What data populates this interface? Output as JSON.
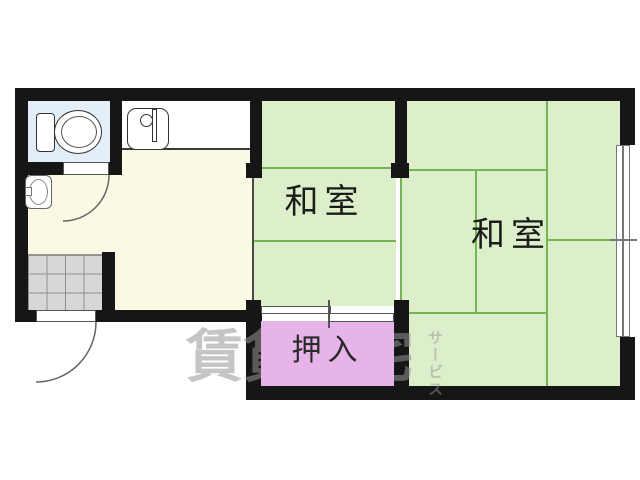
{
  "plan": {
    "type": "japanese-apartment-floor-plan",
    "rooms": {
      "washitsu_center": {
        "label": "和室"
      },
      "washitsu_right": {
        "label": "和室"
      },
      "closet": {
        "label": "押入"
      }
    },
    "watermark": {
      "main": "賃貸住宅",
      "vertical": "サービス"
    },
    "fixtures": [
      "toilet-icon",
      "kitchen-sink-icon",
      "wash-basin-icon",
      "entrance-tile-floor",
      "hinged-door-toilet",
      "hinged-door-entrance",
      "sliding-door-closet",
      "sliding-window-right"
    ],
    "colors": {
      "wall": "#161616",
      "kitchen_floor": "#fbf9e3",
      "tatami_floor": "#dcefca",
      "tatami_line": "#76b556",
      "toilet_floor": "#e4eef9",
      "closet_fill": "#e7b4e9",
      "tile_floor": "#d7d7d7",
      "watermark_gray": "#969696"
    }
  }
}
